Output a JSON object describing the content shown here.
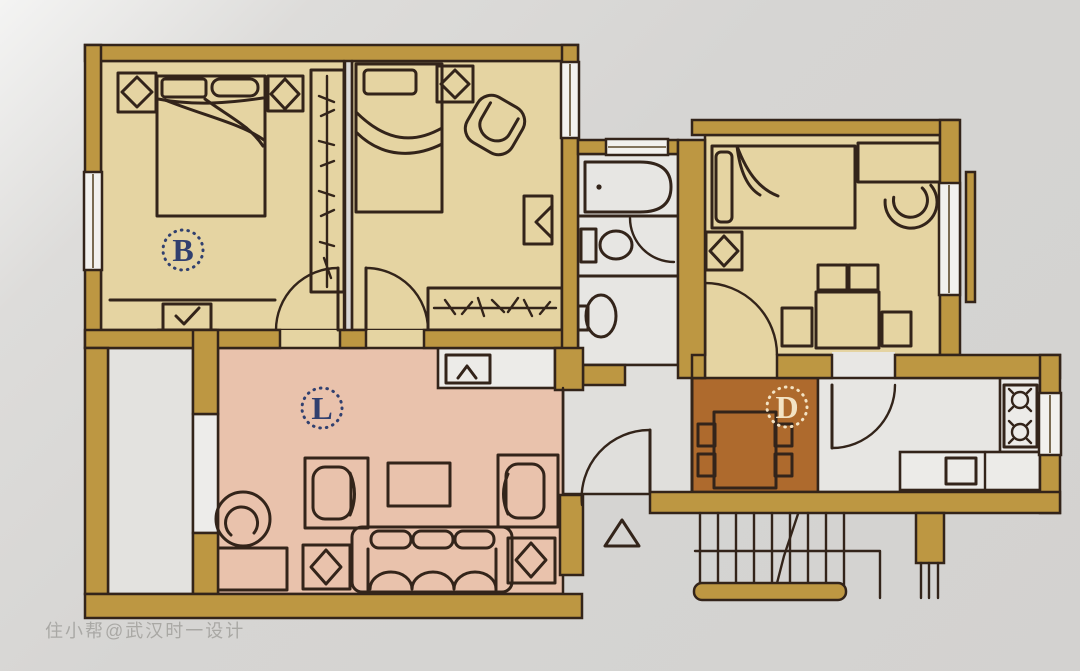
{
  "plan": {
    "type": "apartment-floor-plan",
    "labels": {
      "bedroom_letter": "B",
      "living_letter": "L",
      "dining_letter": "D"
    }
  },
  "watermark": {
    "text": "住小帮@武汉时一设计"
  },
  "colors": {
    "background": "#d6d5d3",
    "wall": "#bd9742",
    "bedroom_floor": "#e5d4a2",
    "living_floor": "#e9c2ac",
    "dining_floor": "#ae6a2d",
    "wet_floor": "#e7e6e3",
    "hall_floor": "#e0dfdc",
    "balcony_floor": "#e3e2df",
    "gap_floor": "#edecea",
    "line": "#33241a",
    "label_blue": "#31406f",
    "label_cream": "#f3e3c4",
    "window_white": "#f2f1ee"
  }
}
